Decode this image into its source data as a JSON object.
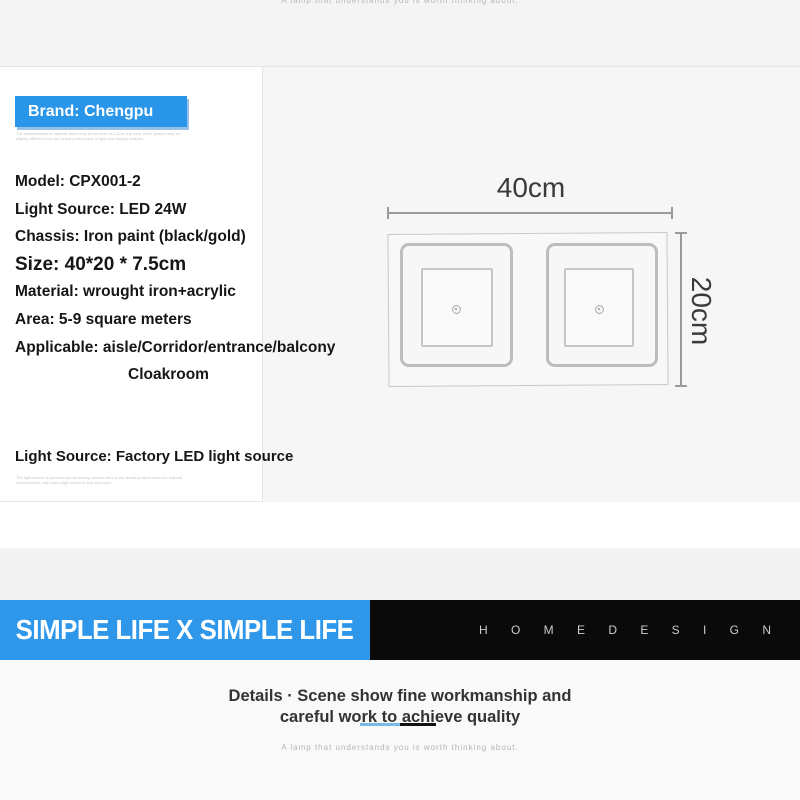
{
  "top": {
    "slogan": "A lamp that understands you is worth thinking about."
  },
  "specs": {
    "brand_badge": "Brand: Chengpu",
    "fine_print_banner": "The measurement is manual, there may be an error of 1-2cm, the color of the picture may be slightly different from the actual product due to light and display reasons",
    "items": [
      "Model: CPX001-2",
      "Light Source: LED 24W",
      "Chassis: Iron paint (black/gold)",
      "Size: 40*20 * 7.5cm",
      "Material: wrought iron+acrylic",
      "Area: 5-9 square meters",
      "Applicable: aisle/Corridor/entrance/balcony",
      "Cloakroom"
    ],
    "light_source_note": "Light Source: Factory LED light source",
    "fine_print_bottom": "The light source is provided by the factory, please refer to the actual product received, manual measurement may have slight errors in size and color"
  },
  "drawing": {
    "width_label": "40cm",
    "height_label": "20cm"
  },
  "brand_bar": {
    "left_text": "SIMPLE LIFE X SIMPLE LIFE",
    "right_text": "H O M E D E S I G N"
  },
  "details": {
    "heading_line1": "Details · Scene show fine workmanship and",
    "heading_line2": "careful work to achieve quality",
    "slogan": "A lamp that understands you is worth thinking about."
  },
  "colors": {
    "accent_blue": "#2e97ea",
    "badge_blue": "#2996ea",
    "bar_black": "#0a0a0a",
    "underline_blue": "#7ab8e6",
    "underline_black": "#111111",
    "panel_gray": "#f6f6f6"
  }
}
